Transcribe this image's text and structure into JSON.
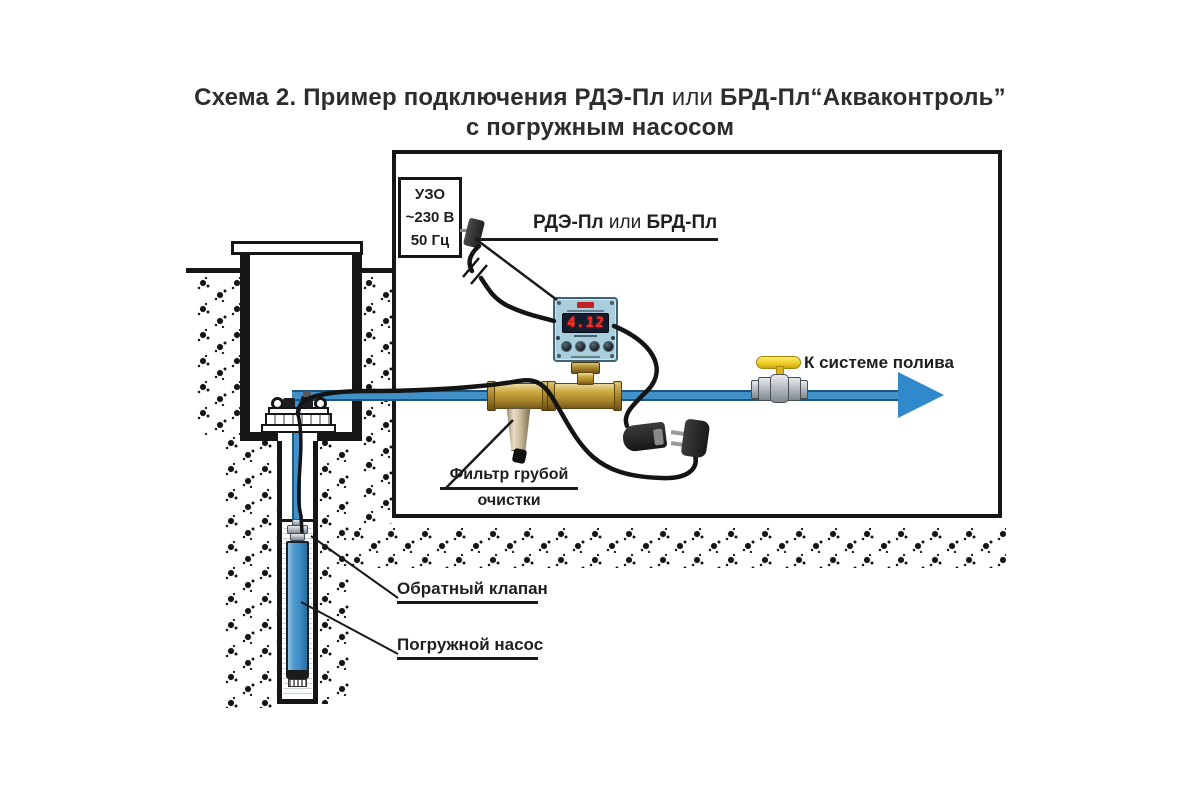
{
  "title": {
    "part1": "Схема 2. Пример подключения РДЭ-Пл ",
    "part2": "или",
    "part3": " БРД-Пл“Акваконтроль”",
    "line2": "с погружным насосом"
  },
  "uzo_box": {
    "line1": "УЗО",
    "line2": "~230 В",
    "line3": "50 Гц"
  },
  "controller_label": {
    "part1": "РДЭ-Пл ",
    "part2": "или",
    "part3": " БРД-Пл"
  },
  "controller": {
    "display_value": "4.12"
  },
  "labels": {
    "irrigation": "К системе полива",
    "filter_line1": "Фильтр грубой",
    "filter_line2": "очистки",
    "check_valve": "Обратный клапан",
    "pump": "Погружной насос"
  },
  "colors": {
    "pipe_blue": "#4191c8",
    "arrow_blue": "#3089cb",
    "pump_blue": "#3d8ec9",
    "device_face": "#a9cede",
    "display_background": "#141c30",
    "display_digits": "#ff2d1e",
    "brass": "#c9a63c",
    "valve_handle_yellow": "#f0d026",
    "line_black": "#1a1a1a"
  }
}
